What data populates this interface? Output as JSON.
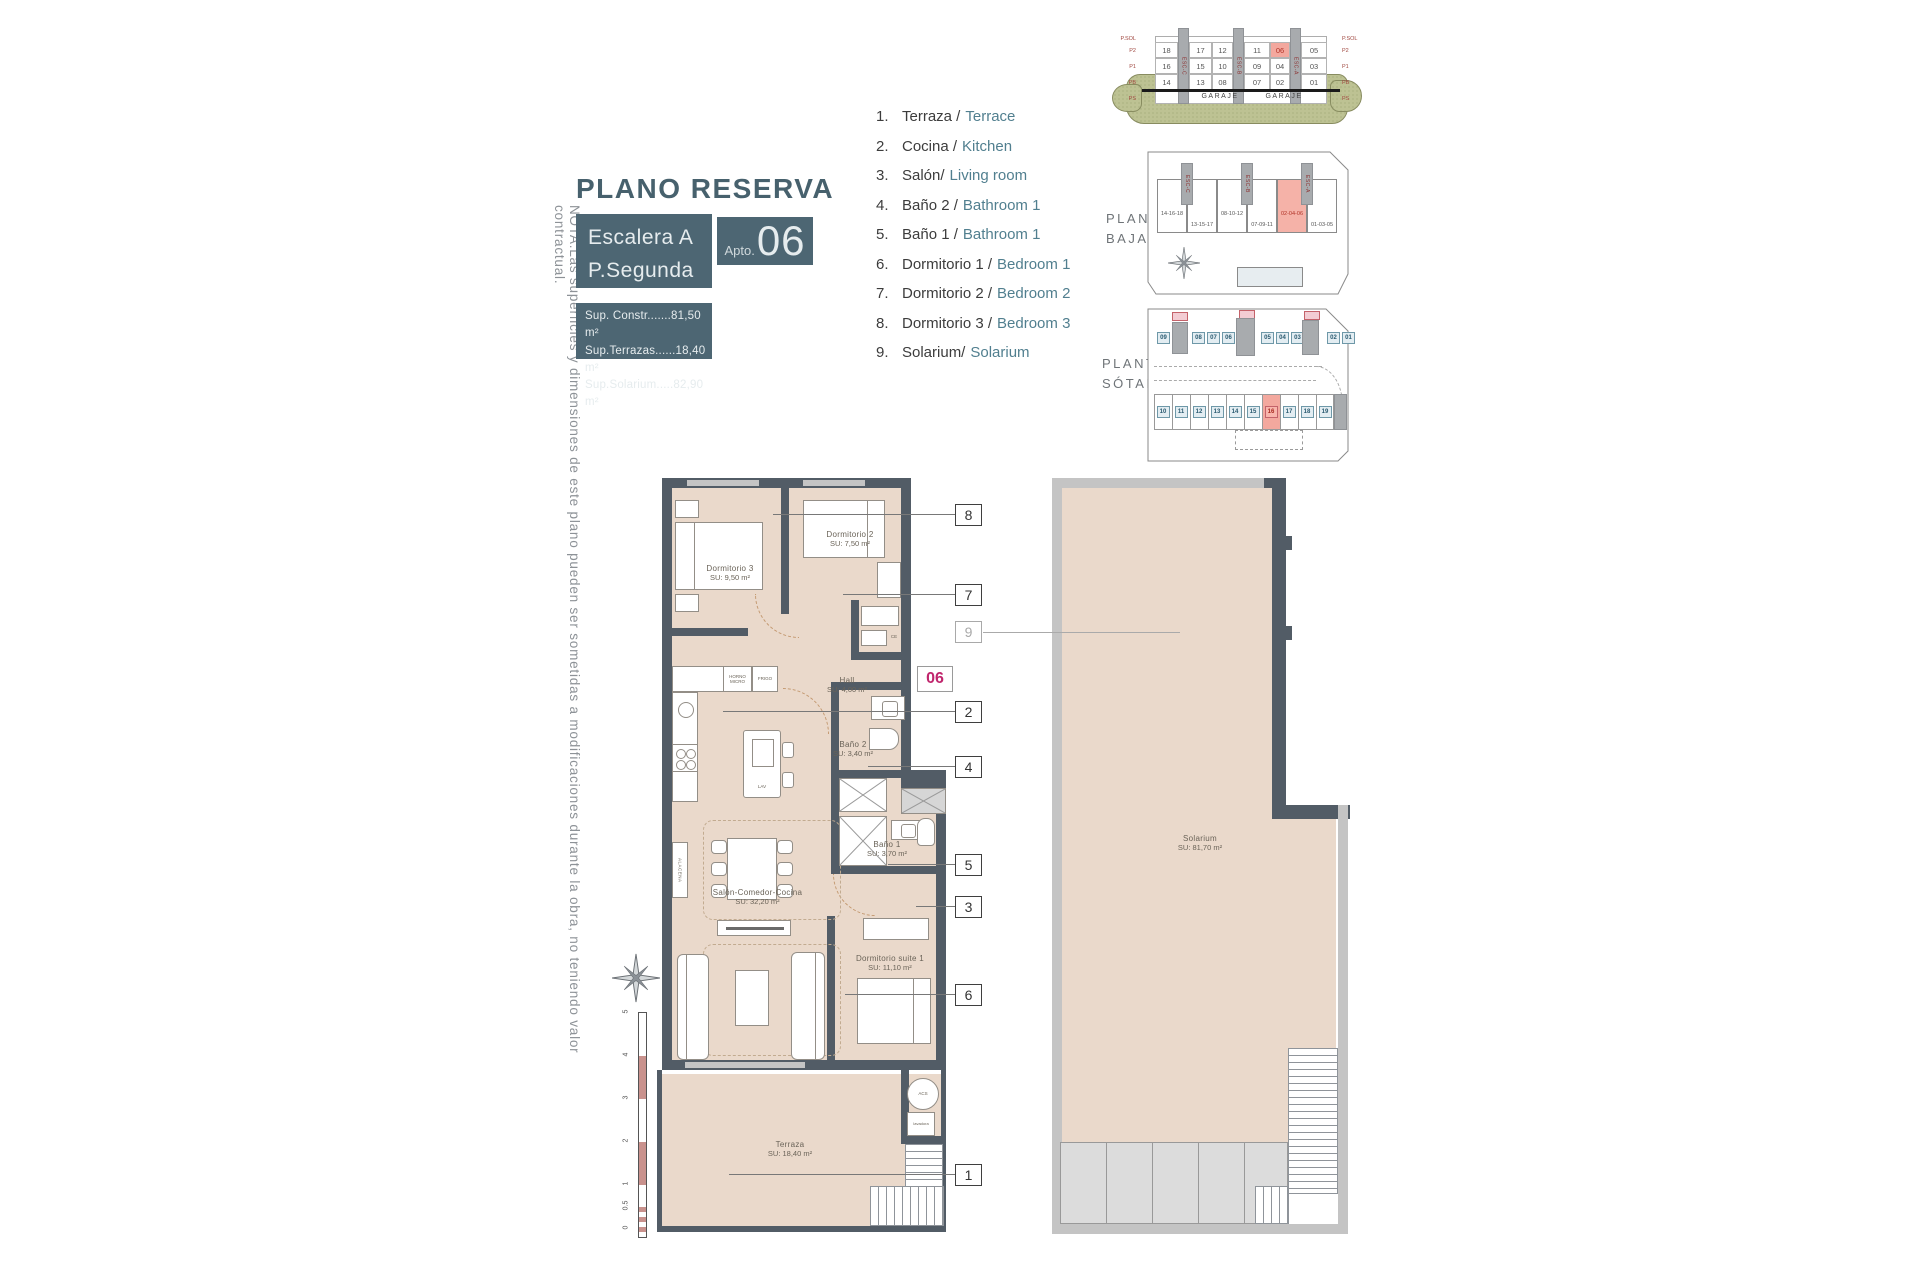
{
  "note_vertical": "NOTA:Las superficies y dimensiones de este plano pueden ser sometidas a modificaciones durante la obra, no teniendo valor contractual.",
  "title": "PLANO RESERVA",
  "unit_box": {
    "escalera": "Escalera A",
    "planta": "P.Segunda",
    "apto_label": "Apto.",
    "apto_number": "06"
  },
  "surfaces": [
    "Sup. Constr.......81,50 m²",
    "Sup.Terrazas......18,40 m²",
    "Sup.Solarium.....82,90 m²"
  ],
  "legend": [
    {
      "num": "1.",
      "es": "Terraza /",
      "en": "Terrace"
    },
    {
      "num": "2.",
      "es": "Cocina /",
      "en": "Kitchen"
    },
    {
      "num": "3.",
      "es": "Salón/",
      "en": "Living room"
    },
    {
      "num": "4.",
      "es": "Baño 2 /",
      "en": "Bathroom 1"
    },
    {
      "num": "5.",
      "es": "Baño 1 /",
      "en": "Bathroom 1"
    },
    {
      "num": "6.",
      "es": "Dormitorio 1 /",
      "en": "Bedroom 1"
    },
    {
      "num": "7.",
      "es": "Dormitorio 2 /",
      "en": "Bedroom 2"
    },
    {
      "num": "8.",
      "es": "Dormitorio 3 /",
      "en": "Bedroom 3"
    },
    {
      "num": "9.",
      "es": "Solarium/",
      "en": "Solarium"
    }
  ],
  "section": {
    "floor_labels": [
      "P.SOL",
      "P2",
      "P1",
      "PB",
      "PS"
    ],
    "rows": [
      [
        {
          "n": "18"
        },
        {
          "n": "17"
        },
        {
          "n": "12"
        },
        {
          "n": "11"
        },
        {
          "n": "06",
          "highlight": true
        },
        {
          "n": "05"
        }
      ],
      [
        {
          "n": "16"
        },
        {
          "n": "15"
        },
        {
          "n": "10"
        },
        {
          "n": "09"
        },
        {
          "n": "04"
        },
        {
          "n": "03"
        }
      ],
      [
        {
          "n": "14"
        },
        {
          "n": "13"
        },
        {
          "n": "08"
        },
        {
          "n": "07"
        },
        {
          "n": "02"
        },
        {
          "n": "01"
        }
      ]
    ],
    "garaje_left": "GARAJE",
    "garaje_right": "GARAJE",
    "esc_labels": [
      "ESC-C",
      "ESC-B",
      "ESC-A"
    ]
  },
  "planta_baja": {
    "label_line1": "PLANTA",
    "label_line2": "BAJA",
    "blocks": [
      {
        "n": "14-16-18"
      },
      {
        "n": "13-15-17"
      },
      {
        "n": "08-10-12"
      },
      {
        "n": "07-09-11"
      },
      {
        "n": "02-04-06",
        "highlight": true
      },
      {
        "n": "01-03-05"
      }
    ],
    "esc_labels": [
      "ESC-C",
      "ESC-B",
      "ESC-A"
    ]
  },
  "planta_sotano": {
    "label_line1": "PLANTA",
    "label_line2": "SÓTANO",
    "top_row": [
      {
        "n": "09"
      },
      {
        "n": "08"
      },
      {
        "n": "07"
      },
      {
        "n": "06"
      },
      {
        "n": "05"
      },
      {
        "n": "04"
      },
      {
        "n": "03"
      },
      {
        "n": "02"
      },
      {
        "n": "01"
      }
    ],
    "bottom_row": [
      {
        "n": "10"
      },
      {
        "n": "11"
      },
      {
        "n": "12"
      },
      {
        "n": "13"
      },
      {
        "n": "14"
      },
      {
        "n": "15"
      },
      {
        "n": "16",
        "highlight": true
      },
      {
        "n": "17"
      },
      {
        "n": "18"
      },
      {
        "n": "19"
      }
    ]
  },
  "floorplan": {
    "unit_marker": "06",
    "rooms": {
      "dormitorio3": {
        "name": "Dormitorio 3",
        "area": "SU: 9,50 m²"
      },
      "dormitorio2": {
        "name": "Dormitorio 2",
        "area": "SU: 7,50 m²"
      },
      "hall": {
        "name": "Hall",
        "area": "SU: 4,00 m²"
      },
      "bano2": {
        "name": "Baño 2",
        "area": "SU: 3,40 m²"
      },
      "bano1": {
        "name": "Baño 1",
        "area": "SU: 3,70 m²"
      },
      "salon": {
        "name": "Salón-Comedor-Cocina",
        "area": "SU: 32,20 m²"
      },
      "suite": {
        "name": "Dormitorio suite 1",
        "area": "SU: 11,10 m²"
      },
      "terraza": {
        "name": "Terraza",
        "area": "SU: 18,40 m²"
      },
      "solarium": {
        "name": "Solarium",
        "area": "SU: 81,70 m²"
      }
    },
    "appliances": {
      "horno_line1": "HORNO",
      "horno_line2": "MICRO",
      "frigo": "FRIGO",
      "lav": "LAV",
      "alacena": "ALACENA",
      "acs": "ACS",
      "lavadora": "lavadora",
      "ce": "CE"
    },
    "callouts": [
      {
        "n": "8"
      },
      {
        "n": "7"
      },
      {
        "n": "9",
        "muted": true
      },
      {
        "n": "2"
      },
      {
        "n": "4"
      },
      {
        "n": "5"
      },
      {
        "n": "3"
      },
      {
        "n": "6"
      },
      {
        "n": "1"
      }
    ],
    "scale_ticks": [
      "5",
      "4",
      "3",
      "2",
      "1",
      "0.5",
      "0"
    ]
  },
  "colors": {
    "teal_brand": "#4d6673",
    "legend_en": "#517f8f",
    "highlight_salmon": "#f3a89e",
    "highlight_red_text": "#b03226",
    "unit_marker_magenta": "#c0266d",
    "wall_dark": "#525c66",
    "floor_beige": "#ead9cb",
    "ground_green": "#bdc293"
  }
}
